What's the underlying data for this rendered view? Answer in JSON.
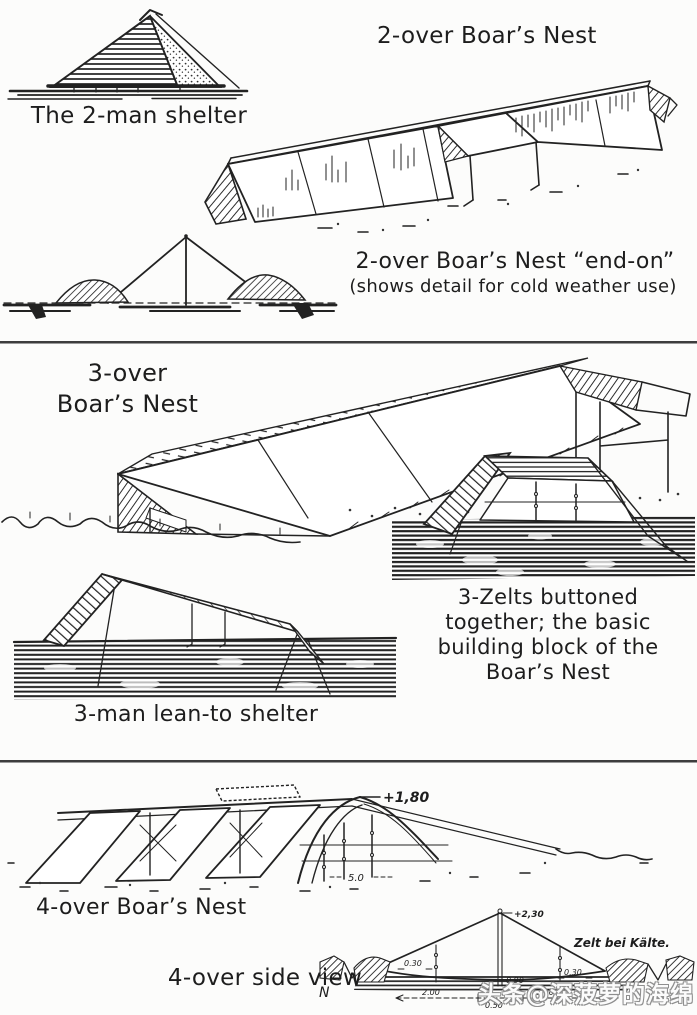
{
  "meta": {
    "background": "#fcfcfb",
    "ink_color": "#1d1d1d",
    "divider_color": "#3d3d3d",
    "watermark_color": "#8f8f8f"
  },
  "section_top": {
    "two_man_caption": "The 2-man shelter",
    "two_over_title": "2-over Boar’s Nest",
    "end_on_title": "2-over Boar’s Nest “end-on”",
    "end_on_subtitle": "(shows detail for cold weather use)"
  },
  "section_mid": {
    "three_over_line1": "3-over",
    "three_over_line2": "Boar’s Nest",
    "zelt_note_line1": "3-Zelts buttoned",
    "zelt_note_line2": "together; the basic",
    "zelt_note_line3": "building block of the",
    "zelt_note_line4": "Boar’s Nest",
    "lean_to_caption": "3-man lean-to shelter"
  },
  "section_bottom": {
    "four_over_caption": "4-over Boar’s Nest",
    "side_view_caption": "4-over side view",
    "dim_ridge_height": "+1,80",
    "dim_span": "5.0",
    "dim_apex": "+2,30",
    "dim_left": "0.30",
    "dim_mid": "0.90",
    "dim_right": "0.30",
    "dim_base_left": "2.00",
    "dim_base_mid": "0.50",
    "dim_base_right": "1.00",
    "datum_label": "N",
    "german_label": "Zelt bei Kälte."
  },
  "watermark": {
    "text": "头条@深菠萝的海绵宝宝"
  }
}
